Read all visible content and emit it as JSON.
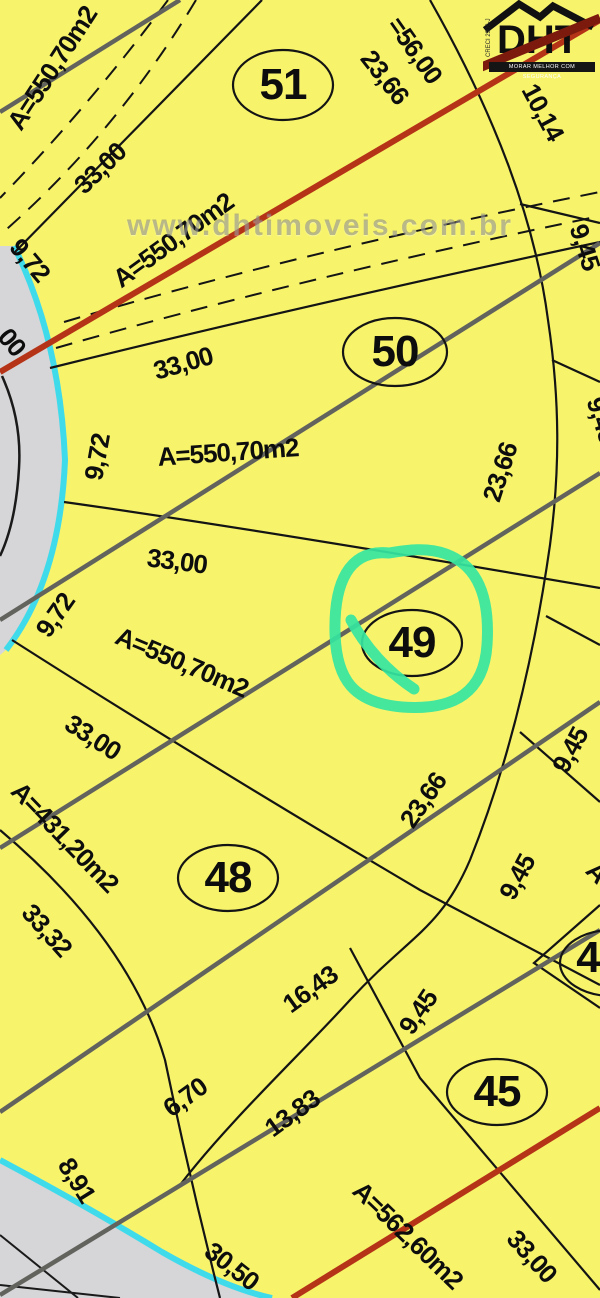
{
  "watermark": {
    "text": "www.dhtimoveis.com.br"
  },
  "logo": {
    "brand": "DHT",
    "tagline": "MORAR MELHOR COM SEGURANÇA",
    "creci": "CRECI 2906-J"
  },
  "highlight": {
    "lot": "49",
    "marker_color": "#35e6a0"
  },
  "colors": {
    "background": "#f7f46c",
    "street": "#d6d5d7",
    "curb_cyan": "#3fdbeb",
    "road_red": "#b53417",
    "utility_gray": "#63635e",
    "line_black": "#141414",
    "marker_green": "#35e6a0"
  },
  "lots": [
    {
      "number": "51"
    },
    {
      "number": "50"
    },
    {
      "number": "49"
    },
    {
      "number": "48"
    },
    {
      "number": "45"
    },
    {
      "number": "4"
    }
  ],
  "labels": [
    {
      "text": "A=550,70m2"
    },
    {
      "text": "33,00"
    },
    {
      "text": "9,72"
    },
    {
      "text": "00"
    },
    {
      "text": "=56,00"
    },
    {
      "text": "23,66"
    },
    {
      "text": "10,14"
    },
    {
      "text": "9,45"
    },
    {
      "text": "A=550,70m2"
    },
    {
      "text": "33,00"
    },
    {
      "text": "9,72"
    },
    {
      "text": "A=550,70m2"
    },
    {
      "text": "23,66"
    },
    {
      "text": "33,00"
    },
    {
      "text": "9,72"
    },
    {
      "text": "A=550,70m2"
    },
    {
      "text": "33,00"
    },
    {
      "text": "A=431,20m2"
    },
    {
      "text": "33,32"
    },
    {
      "text": "23,66"
    },
    {
      "text": "9,45"
    },
    {
      "text": "9,45"
    },
    {
      "text": "9,45"
    },
    {
      "text": "16,43"
    },
    {
      "text": "9,45"
    },
    {
      "text": "6,70"
    },
    {
      "text": "13,83"
    },
    {
      "text": "8,91"
    },
    {
      "text": "A=562,60m2"
    },
    {
      "text": "30,50"
    },
    {
      "text": "33,00"
    },
    {
      "text": "A"
    }
  ]
}
